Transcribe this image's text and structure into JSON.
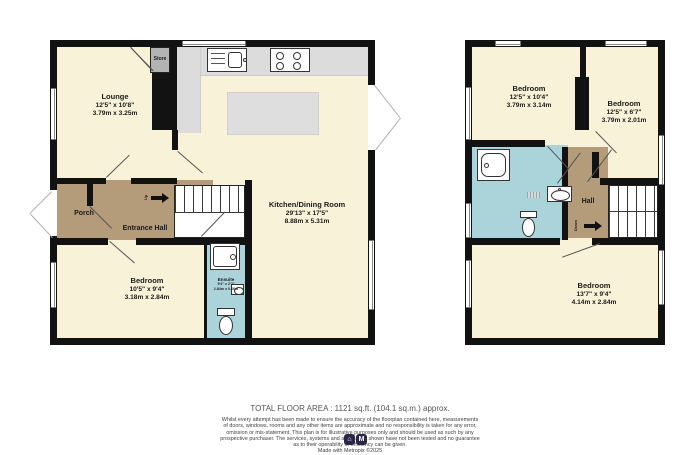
{
  "title": "Two storey property floorplan",
  "colors": {
    "room_cream": "#f7f2d8",
    "hall_brown": "#b49b79",
    "bath_blue": "#abd3da",
    "counter_gray": "#dcdcdc",
    "store_gray": "#b3b3b3",
    "wall_black": "#121212",
    "logo_bg": "#2b2546"
  },
  "ground_floor": {
    "lounge": {
      "name": "Lounge",
      "imperial": "12'5\" x 10'8\"",
      "metric": "3.79m x 3.25m"
    },
    "store": {
      "name": "Store"
    },
    "kitchen_dining": {
      "name": "Kitchen/Dining Room",
      "imperial": "29'13\" x 17'5\"",
      "metric": "8.88m x 5.31m"
    },
    "porch": {
      "name": "Porch"
    },
    "entrance_hall": {
      "name": "Entrance Hall"
    },
    "bedroom": {
      "name": "Bedroom",
      "imperial": "10'5\" x 9'4\"",
      "metric": "3.18m x 2.84m"
    },
    "ensuite": {
      "name": "Ensuite",
      "imperial": "9'4\" x 2'2\"",
      "metric": "2.84m x 0.66m"
    },
    "stair_direction": "Up"
  },
  "first_floor": {
    "bedroom_left": {
      "name": "Bedroom",
      "imperial": "12'5\" x 10'4\"",
      "metric": "3.79m x 3.14m"
    },
    "bedroom_right": {
      "name": "Bedroom",
      "imperial": "12'5\" x 6'7\"",
      "metric": "3.79m x 2.01m"
    },
    "hall": {
      "name": "Hall"
    },
    "bedroom_back": {
      "name": "Bedroom",
      "imperial": "13'7\" x 9'4\"",
      "metric": "4.14m x 2.84m"
    },
    "stair_direction": "Down"
  },
  "footer": {
    "total_area": "TOTAL FLOOR AREA : 1121 sq.ft. (104.1 sq.m.) approx.",
    "disclaimer_lines": [
      "Whilst every attempt has been made to ensure the accuracy of the floorplan contained here, measurements",
      "of doors, windows, rooms and any other items are approximate and no responsibility is taken for any error,",
      "omission or mis-statement. This plan is for illustrative purposes only and should be used as such by any",
      "prospective purchaser. The services, systems and appliances shown have not been tested and no guarantee",
      "as to their operability or efficiency can be given."
    ],
    "credit": "Made with Metropix ©2025",
    "logo_glyphs": [
      "⌂",
      "M"
    ]
  }
}
